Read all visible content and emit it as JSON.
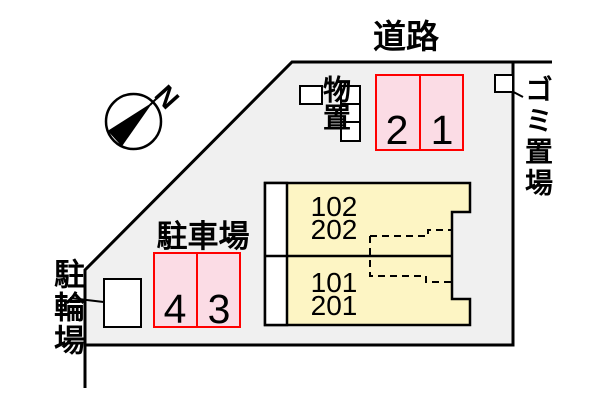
{
  "colors": {
    "site-fill": "#f0f0f0",
    "line": "#000000",
    "parking-fill": "#fbdce5",
    "parking-border": "#ff0000",
    "building-fill": "#fdf5c4",
    "box-fill": "#ffffff"
  },
  "labels": {
    "road": "道路",
    "garbage_area": "ゴミ置場",
    "storage": "物置",
    "parking_lot": "駐車場",
    "bicycle_parking": "駐輪場",
    "north": "N"
  },
  "parking_spaces": {
    "north_row": [
      "2",
      "1"
    ],
    "south_row": [
      "4",
      "3"
    ]
  },
  "building_units": {
    "north_unit": [
      "102",
      "202"
    ],
    "south_unit": [
      "101",
      "201"
    ]
  }
}
